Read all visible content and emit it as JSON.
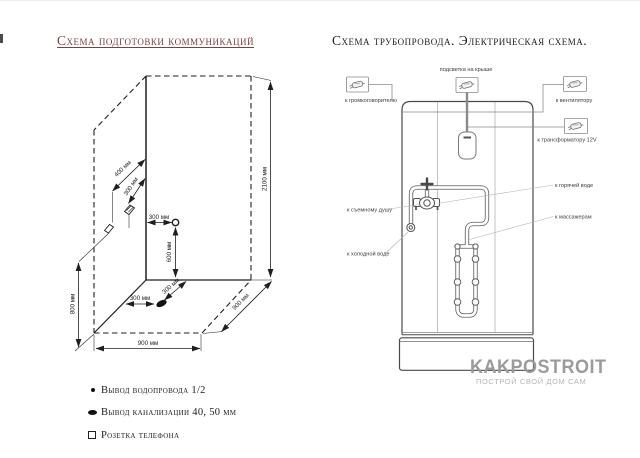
{
  "left": {
    "title": "Схема подготовки коммуникаций",
    "dims": {
      "wall_height": "2100 мм",
      "socket_height": "800 мм",
      "floor_width": "900 мм",
      "floor_depth": "900 мм",
      "water_height": "600 мм",
      "socket_far_offset": "400 мм",
      "socket_near_offset": "300 мм",
      "water_wall_offset": "300 мм",
      "drain_side_offset": "300 мм",
      "drain_back_offset": "300 мм"
    },
    "legend": [
      {
        "label": "Вывод водопровода 1/2"
      },
      {
        "label": "Вывод канализации 40, 50 мм"
      },
      {
        "label": "Розетка телефона"
      }
    ]
  },
  "right": {
    "title": "Схема трубопровода. Электрическая схема.",
    "labels": {
      "roof_light": "подсветка на крыше",
      "speaker": "к громкоговорителю",
      "fan": "к вентилятору",
      "transformer": "к трансформатору 12V",
      "hot_water": "к горячей воде",
      "massagers": "к массажерам",
      "hand_shower": "к съемному душу",
      "cold_water": "к холодной воде"
    },
    "watermark": {
      "brand": "KAKPOSTROIT",
      "slogan": "ПОСТРОЙ СВОЙ ДОМ САМ"
    }
  },
  "colors": {
    "title_left": "#7b4141",
    "line_dark": "#1f1f1f",
    "line_gray": "#5a5a5a",
    "watermark": "#9b9b9b"
  }
}
